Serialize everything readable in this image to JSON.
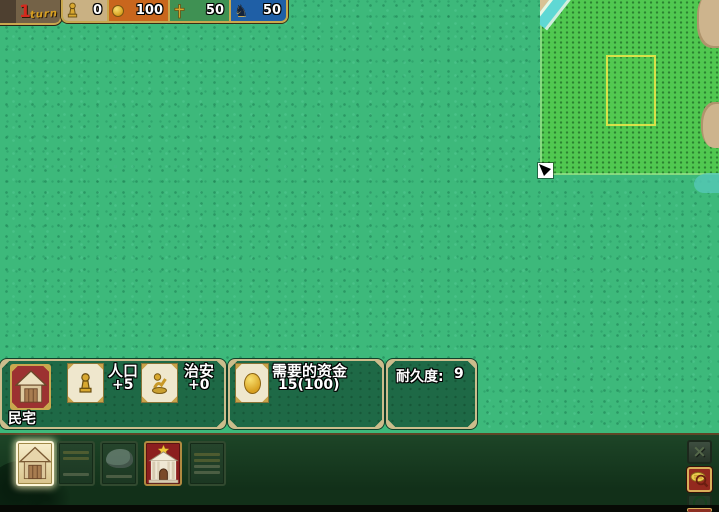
{
  "colors": {
    "grass": "#3db97b",
    "placement_highlight": "#50c850",
    "placement_outline": "#d9e14a",
    "panel_green": "#1e6946",
    "panel_border": "#cbbd8c",
    "gold_trim": "#c9a84e",
    "resource_tan": "#c9b183",
    "resource_orange": "#c9661d",
    "resource_green": "#3f9153",
    "resource_blue": "#1f5fa6",
    "selected_building_red": "#9c3131",
    "church_red": "#8c1f1f"
  },
  "top_bar": {
    "turn_number": "1",
    "turn_label": "turn",
    "resources": [
      {
        "name": "population",
        "icon": "pawn-icon",
        "value": "0"
      },
      {
        "name": "gold",
        "icon": "coin-icon",
        "value": "100"
      },
      {
        "name": "faith",
        "icon": "cross-icon",
        "value": "50"
      },
      {
        "name": "knights",
        "icon": "knight-icon",
        "value": "50"
      }
    ]
  },
  "building_info": {
    "name": "民宅",
    "stats": [
      {
        "name": "population",
        "label": "人口",
        "value": "+5"
      },
      {
        "name": "security",
        "label": "治安",
        "value": "+0"
      }
    ],
    "cost": {
      "label": "需要的资金",
      "value": "15(100)"
    },
    "durability": {
      "label": "耐久度:",
      "value": "9"
    }
  },
  "toolbar": {
    "buildings": [
      {
        "name": "house",
        "state": "selected"
      },
      {
        "name": "wall",
        "state": "disabled"
      },
      {
        "name": "rock",
        "state": "disabled"
      },
      {
        "name": "church",
        "state": "enabled"
      },
      {
        "name": "storage",
        "state": "disabled"
      }
    ]
  },
  "icons": {
    "close_glyph": "×",
    "knight_glyph": "♞"
  }
}
